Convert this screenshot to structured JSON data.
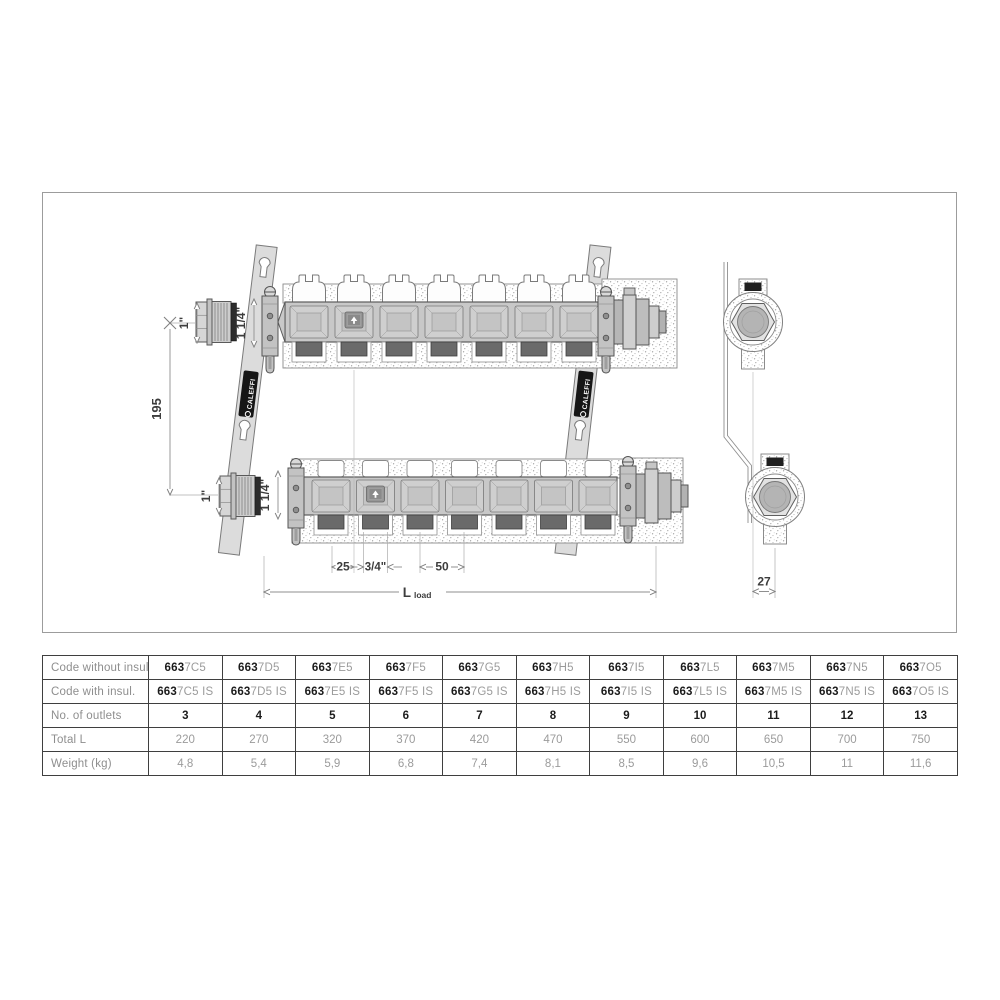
{
  "drawing": {
    "brand": "CALEFFI",
    "dims": {
      "inlet_top": "1\"",
      "manifold_size_top": "1 1/4\"",
      "center_distance": "195",
      "inlet_bottom": "1\"",
      "manifold_size_bottom": "1 1/4\"",
      "outlet_offset": "25",
      "outlet_connection": "3/4\"",
      "outlet_pitch": "50",
      "length_label": "L",
      "length_sub": "load",
      "depth_offset": "27"
    }
  },
  "table": {
    "row_labels": [
      "Code without insul.",
      "Code with insul.",
      "No. of outlets",
      "Total L",
      "Weight (kg)"
    ],
    "code_prefix": "663",
    "insul_suffix": " IS",
    "columns": [
      {
        "code": "7C5",
        "outlets": "3",
        "total_l": "220",
        "weight": "4,8"
      },
      {
        "code": "7D5",
        "outlets": "4",
        "total_l": "270",
        "weight": "5,4"
      },
      {
        "code": "7E5",
        "outlets": "5",
        "total_l": "320",
        "weight": "5,9"
      },
      {
        "code": "7F5",
        "outlets": "6",
        "total_l": "370",
        "weight": "6,8"
      },
      {
        "code": "7G5",
        "outlets": "7",
        "total_l": "420",
        "weight": "7,4"
      },
      {
        "code": "7H5",
        "outlets": "8",
        "total_l": "470",
        "weight": "8,1"
      },
      {
        "code": "7I5",
        "outlets": "9",
        "total_l": "550",
        "weight": "8,5"
      },
      {
        "code": "7L5",
        "outlets": "10",
        "total_l": "600",
        "weight": "9,6"
      },
      {
        "code": "7M5",
        "outlets": "11",
        "total_l": "650",
        "weight": "10,5"
      },
      {
        "code": "7N5",
        "outlets": "12",
        "total_l": "700",
        "weight": "11"
      },
      {
        "code": "7O5",
        "outlets": "13",
        "total_l": "750",
        "weight": "11,6"
      }
    ]
  }
}
